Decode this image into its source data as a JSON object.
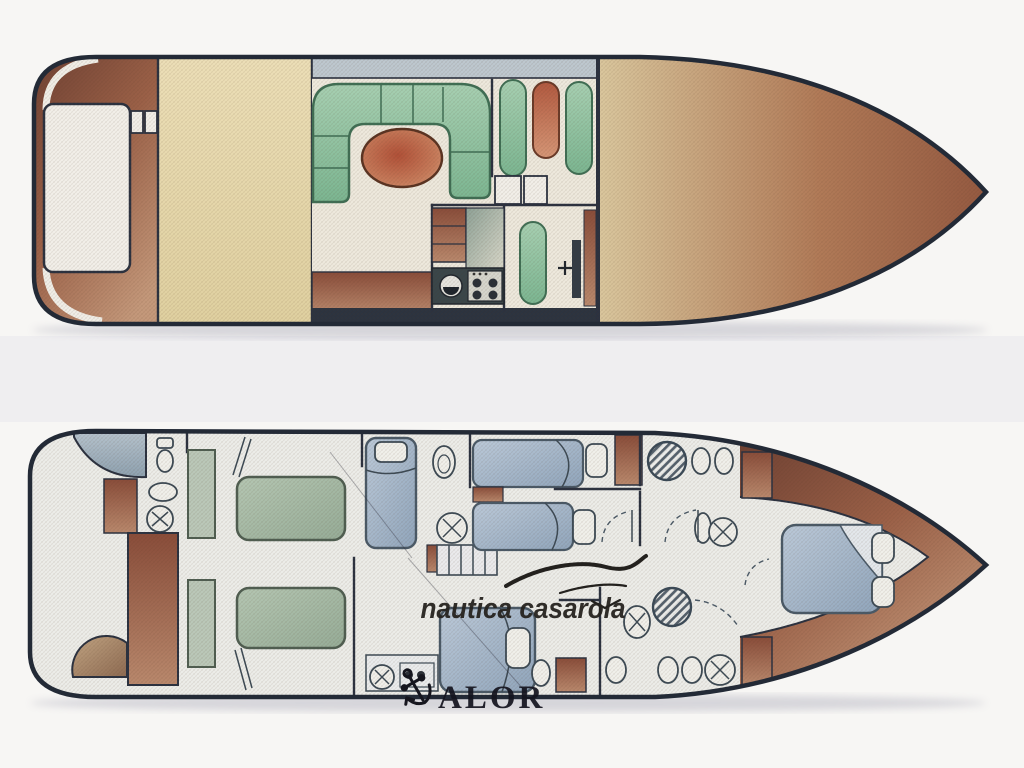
{
  "page": {
    "description": "Scanned yacht brochure showing two deck floor plans (main deck and lower deck)",
    "background": "#f7f6f4"
  },
  "watermarks": {
    "dealer": {
      "text": "nautica casarola",
      "icon": "seagull-icon",
      "color": "#26231f"
    },
    "brand": {
      "text": "ALOR",
      "display_reads_as": "CALOR",
      "icon": "anchor-icon",
      "color": "#15151f"
    }
  },
  "decks": {
    "main_deck": {
      "id": "main-deck-plan",
      "areas": [
        "swim-platform",
        "aft-deck",
        "salon-u-sofa",
        "oval-table",
        "helm-seats",
        "galley-cabinets",
        "galley-sink",
        "galley-stove",
        "fridge-locker",
        "helm-console",
        "foredeck"
      ]
    },
    "lower_deck": {
      "id": "lower-deck-plan",
      "areas": [
        "aft-head-shower",
        "aft-head-toilet",
        "aft-head-washbasin",
        "twin-bed-cabin",
        "companionway-stairs",
        "guest-cabin-bed",
        "bunk-cabin-beds",
        "mid-head-shower",
        "mid-head-toilets",
        "aft-mid-double-bed",
        "fwd-head-shower",
        "fwd-head-toilets",
        "vip-bow-double-bed",
        "door-swings"
      ]
    }
  },
  "palette": {
    "hull_outline": "#232a36",
    "teak_brown": "#8c4f3a",
    "teak_light": "#c29478",
    "deck_cream": "#e9dcae",
    "sofa_green": "#8fc2a2",
    "table_red": "#b25138",
    "bed_blue": "#a9bccf",
    "bed_green": "#a9bfab",
    "shower_blue": "#aebdc8",
    "floor_white": "#f0eee4",
    "counter_dark": "#39464a"
  }
}
